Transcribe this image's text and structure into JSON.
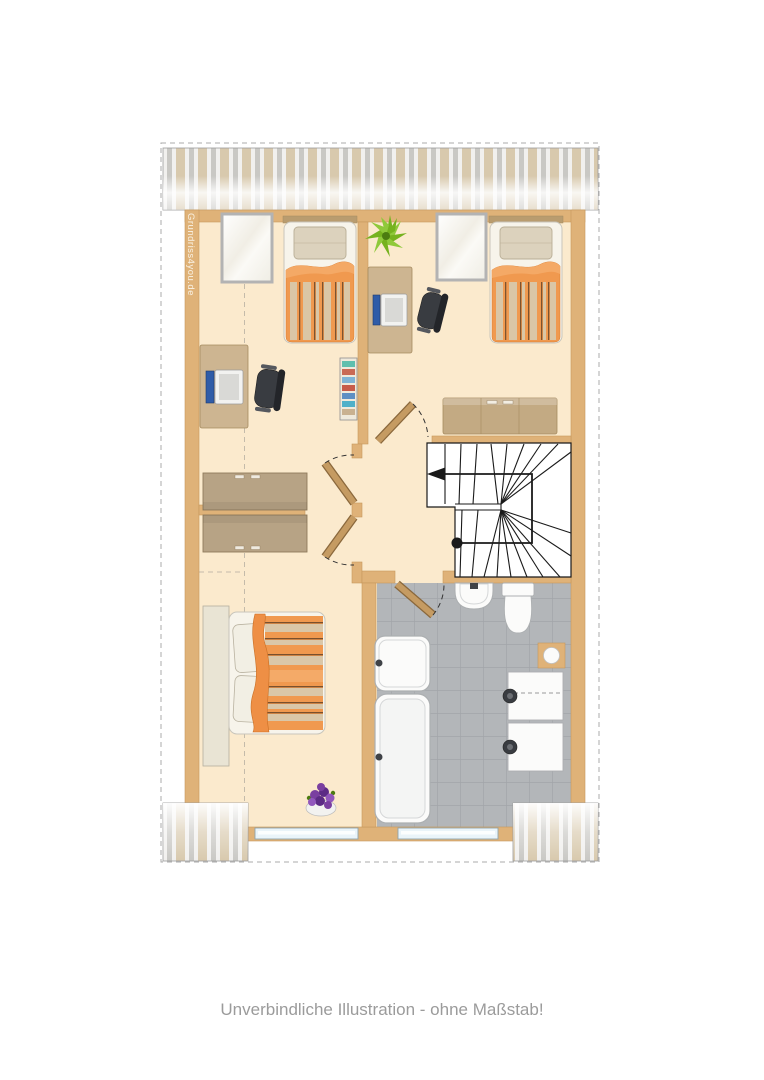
{
  "watermark": {
    "text": "Grundriss4you.de"
  },
  "caption": {
    "text": "Unverbindliche Illustration - ohne Maßstab!"
  },
  "icons": [
    "single-bed-icon",
    "double-bed-icon",
    "desk-icon",
    "computer-icon",
    "office-chair-icon",
    "potted-plant-icon",
    "bookshelf-icon",
    "wardrobe-icon",
    "sideboard-icon",
    "staircase-icon",
    "walk-line-arrow-icon",
    "door-icon",
    "door-swing-arc-icon",
    "roof-window-icon",
    "window-icon",
    "washbasin-icon",
    "toilet-icon",
    "shower-icon",
    "bathtub-icon",
    "washing-machine-icon",
    "chimney-icon",
    "flower-pot-icon",
    "roof-overhang-icon",
    "knee-wall-line-icon"
  ],
  "colors": {
    "floor": "#FBEACD",
    "wall": "#DFB278",
    "wallEdge": "#C6985C",
    "tile": "#B3B6B9",
    "tileLine": "#A2A5A9",
    "stairLine": "#1A1A1A",
    "orange": "#F0994F",
    "orangeDeep": "#D97B2E",
    "orangeLight": "#F5AC6B",
    "stripeBeige": "#D8CDB2",
    "stripeDark": "#6E4A2B",
    "pillow": "#DCD2BD",
    "pillowEdge": "#B9AE96",
    "bedFrame": "#F7F4EB",
    "bedFrameEdge": "#C8C5BB",
    "headboard": "#E9E4D4",
    "headRail": "#B99C6F",
    "furnTan": "#CDB591",
    "furnEdge": "#A68C60",
    "wardrobe": "#B7A385",
    "wardrobeEdge": "#8F7B5C",
    "sideboard": "#C3AA83",
    "chair": "#393C41",
    "chairDark": "#232529",
    "chairLight": "#55585E",
    "screenBlue": "#2F5CA8",
    "laptop": "#F2F2F0",
    "fixture": "#FBFBFA",
    "fixtureEdge": "#ACAFB1",
    "fixtureInner": "#D5D7D8",
    "tapDark": "#3F4247",
    "glass": "#EAF4F9",
    "glassEdge": "#8FA3AD",
    "doorLeaf": "#C59B62",
    "doorLeafEdge": "#8A683C",
    "arcDash": "#333333",
    "plantGreen": "#76B21E",
    "plantGreenLight": "#8FC93A",
    "plantGreenDark": "#4C7C10",
    "flowerPurple": "#7A3FA0",
    "flowerPurpleDark": "#5C2B85",
    "flowerPurpleLight": "#9157BC",
    "shelf": "#EFE9DB",
    "roofBeige": "#D8C9AD",
    "roofGray": "#C9C8C4",
    "roofWhite": "#F1F0EE",
    "roofBorder": "#9C9C9C",
    "cutLine": "#ABABAB",
    "kneeDash": "#C4BBAA",
    "caption": "#9B9B9B",
    "watermark": "rgba(253,250,243,0.88)"
  }
}
